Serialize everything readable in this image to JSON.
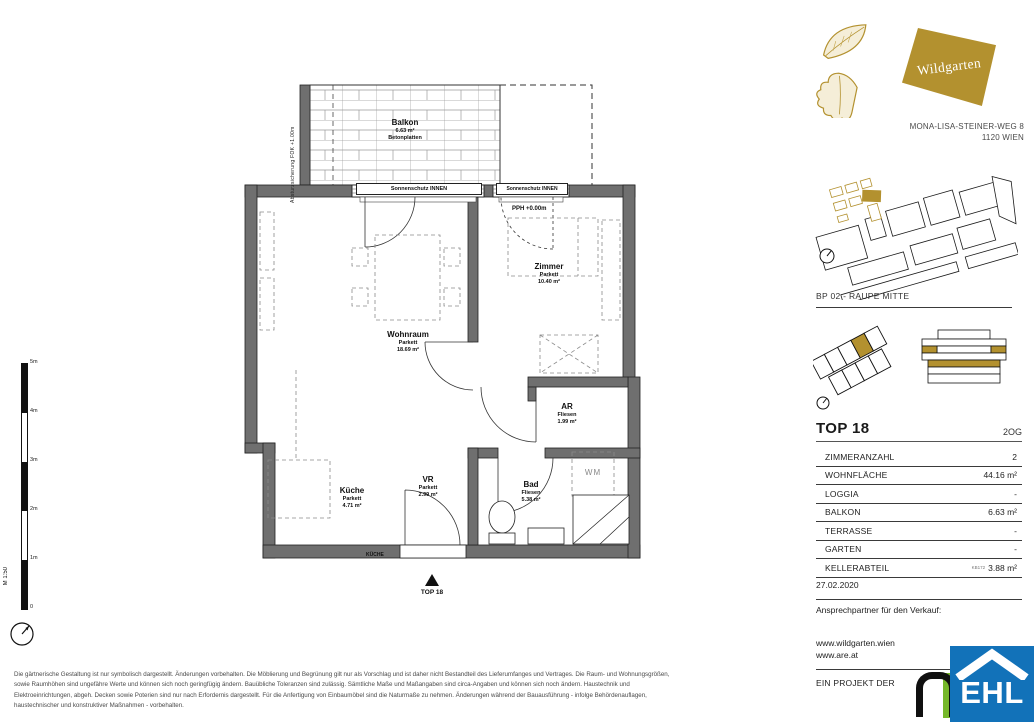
{
  "header": {
    "logo_text": "Wildgarten",
    "address_line1": "MONA-LISA-STEINER-WEG 8",
    "address_line2": "1120 WIEN",
    "site_label": "BP 02 - RAUPE MITTE"
  },
  "unit": {
    "title": "TOP 18",
    "floor": "2OG",
    "specs": [
      {
        "label": "ZIMMERANZAHL",
        "note": "",
        "value": "2"
      },
      {
        "label": "WOHNFLÄCHE",
        "note": "",
        "value": "44.16 m²"
      },
      {
        "label": "LOGGIA",
        "note": "",
        "value": "-"
      },
      {
        "label": "BALKON",
        "note": "",
        "value": "6.63 m²"
      },
      {
        "label": "TERRASSE",
        "note": "",
        "value": "-"
      },
      {
        "label": "GARTEN",
        "note": "",
        "value": "-"
      },
      {
        "label": "KELLERABTEIL",
        "note": "KB172",
        "value": "3.88 m²"
      }
    ],
    "date": "27.02.2020",
    "contact_label": "Ansprechpartner für den Verkauf:",
    "website1": "www.wildgarten.wien",
    "website2": "www.are.at",
    "project_label": "EIN PROJEKT DER"
  },
  "plan": {
    "scale_label": "M 1:50",
    "scale_ticks": [
      "5m",
      "4m",
      "3m",
      "2m",
      "1m",
      "0"
    ],
    "balcony": {
      "name": "Balkon",
      "area": "6.63 m²",
      "finish": "Betonplatten"
    },
    "railing_note": "Absturzsicherung FOK +1.00m",
    "sunshade_note": "Sonnenschutz INNEN",
    "level_note": "PPH +0.00m",
    "kitchen_note": "KÜCHE",
    "washer_label": "WM",
    "entrance_label": "TOP 18",
    "rooms": [
      {
        "name": "Wohnraum",
        "finish": "Parkett",
        "area": "18.69 m²"
      },
      {
        "name": "Zimmer",
        "finish": "Parkett",
        "area": "10.40 m²"
      },
      {
        "name": "AR",
        "finish": "Fliesen",
        "area": "1.99 m²"
      },
      {
        "name": "Bad",
        "finish": "Fliesen",
        "area": "5.38 m²"
      },
      {
        "name": "Küche",
        "finish": "Parkett",
        "area": "4.71 m²"
      },
      {
        "name": "VR",
        "finish": "Parkett",
        "area": "2.99 m²"
      }
    ]
  },
  "logos": {
    "ehl_text": "EHL"
  },
  "colors": {
    "brand_gold": "#b3912f",
    "wall_gray": "#6f6f6f",
    "ehl_blue": "#1272b9",
    "are_green": "#76b82a"
  },
  "footer": {
    "disclaimer": [
      "Die gärtnerische Gestaltung ist nur symbolisch dargestellt. Änderungen vorbehalten. Die Möblierung und Begrünung gilt nur als Vorschlag und ist daher nicht Bestandteil des Lieferumfanges und Vertrages. Die Raum- und Wohnungsgrößen,",
      "sowie Raumhöhen sind ungefähre Werte und können sich noch geringfügig ändern. Bauübliche Toleranzen sind zulässig. Sämtliche Maße und Maßangaben sind circa-Angaben und können sich noch ändern. Haustechnik und",
      "Elektroeinrichtungen, abgeh. Decken sowie Poterien sind nur nach Erfordernis dargestellt. Für die Anfertigung von Einbaumöbel sind die Naturmaße zu nehmen. Änderungen während der Bauausführung - infolge Behördenauflagen,",
      "haustechnischer und konstruktiver Maßnahmen - vorbehalten."
    ]
  }
}
